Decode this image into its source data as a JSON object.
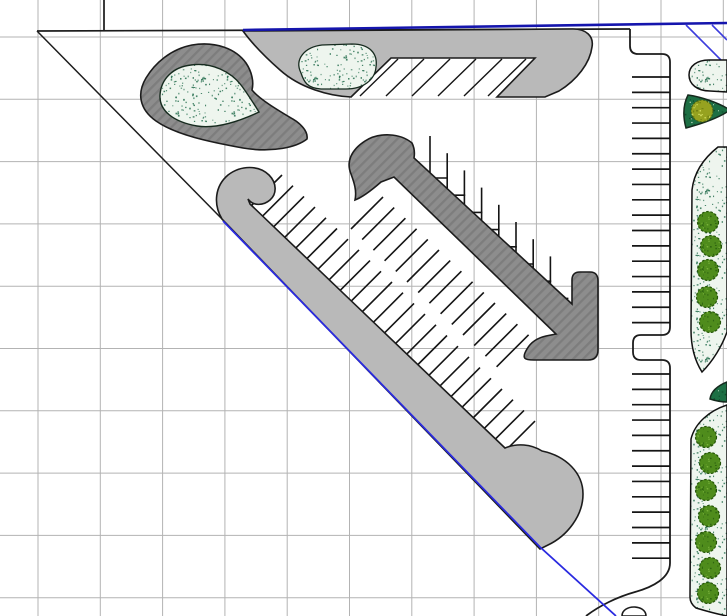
{
  "canvas": {
    "width": 727,
    "height": 616,
    "background": "#ffffff",
    "kind": "cad-site-plan-parking-layout"
  },
  "colors": {
    "grid": "#b3b3b3",
    "outline": "#1c1c1c",
    "curb_light": "#b9b9b9",
    "curb_dark_base": "#8d8d8d",
    "curb_dark_hatch": "#7d7d7d",
    "boundary_blue": "#1515ad",
    "guide_blue": "#3c3cdd",
    "diag_blue": "#2a2ae0",
    "bed_fill": "#eef5ee",
    "bed_speck": "#2c7253",
    "bed_outline": "#162a1e",
    "dense_fill": "#1d6f44",
    "dense_speck_dark": "#0d4527",
    "dense_speck_light": "#cfe3cf",
    "olive_base": "#96a220",
    "olive_dark": "#6a7a10",
    "olive_light": "#d2dd5e",
    "tree_base": "#4f8c1c",
    "tree_dark": "#2d6410",
    "tree_light": "#7ab33b",
    "tree_edge": "#245409",
    "tick": "#141414",
    "corner_tick": "#3a3a3a"
  },
  "grid": {
    "spacing": 62.3,
    "offset_x": 38,
    "offset_y": 37,
    "cols": 12,
    "rows": 10
  },
  "boundary_lines": [
    {
      "name": "property-top-line",
      "x1": 37,
      "y1": 31,
      "x2": 630,
      "y2": 29,
      "stroke": "#1c1c1c",
      "w": 1.7
    },
    {
      "name": "property-hypotenuse-line",
      "x1": 37,
      "y1": 31,
      "x2": 223,
      "y2": 220,
      "stroke": "#1c1c1c",
      "w": 1.5
    },
    {
      "name": "corner-stub-line",
      "x1": 104,
      "y1": 0,
      "x2": 104,
      "y2": 30,
      "stroke": "#3a3a3a",
      "w": 2
    }
  ],
  "blue_lines": [
    {
      "name": "row-blue-top-line",
      "pts": "243,30 727,23",
      "stroke": "#1515ad",
      "w": 2.6
    },
    {
      "name": "row-blue-diagonal-line",
      "pts": "223,221 540,547 616,616",
      "stroke": "#2a2ae0",
      "w": 1.8
    },
    {
      "name": "guide-blue-diagonal-1",
      "pts": "686,25 727,66",
      "stroke": "#3c3cdd",
      "w": 1.6
    },
    {
      "name": "guide-blue-diagonal-2",
      "pts": "712,25 727,40",
      "stroke": "#3c3cdd",
      "w": 1.6
    }
  ],
  "right_road": {
    "curb_path": "M630,29 L630,46 Q630,54 638,54 L662,54 Q670,54 670,62 L670,327 Q670,335 662,335 L641,335 Q633,335 633,343 L633,352 Q633,360 641,360 L662,360 Q670,360 670,368 L670,563 C670,578 653,587 635,592 C617,597 599,606 586,616",
    "bottom_bump_path": "M622,616 C622,604 646,604 646,616 Z",
    "stall_rows": [
      {
        "x1": 632,
        "x2": 670,
        "y_start": 77,
        "step": 15.35,
        "count": 17
      },
      {
        "x1": 632,
        "x2": 670,
        "y_start": 374,
        "step": 15.35,
        "count": 13
      }
    ]
  },
  "top_median": {
    "outline_path": "M243,31 L573,29 C586,29 594,36 592,47 C590,63 577,80 559,91 L545,97 L497,97 L535,58 L391,58 L351,97 C329,96 300,88 280,70 C263,55 251,42 243,31 Z",
    "hatch_lines": [
      {
        "x1": 360,
        "y1": 96,
        "x2": 398,
        "y2": 59
      },
      {
        "x1": 386,
        "y1": 96,
        "x2": 424,
        "y2": 59
      },
      {
        "x1": 412,
        "y1": 96,
        "x2": 450,
        "y2": 59
      },
      {
        "x1": 438,
        "y1": 96,
        "x2": 476,
        "y2": 59
      },
      {
        "x1": 464,
        "y1": 96,
        "x2": 502,
        "y2": 59
      },
      {
        "x1": 488,
        "y1": 96,
        "x2": 526,
        "y2": 59
      }
    ],
    "bed_path": "M301,73 C294,59 305,47 322,45 L352,44 C369,44 378,53 376,67 C375,80 363,89 346,89 L321,89 C307,88 304,82 301,73 Z"
  },
  "teardrop_island": {
    "outer_path": "M307,139 C297,147 273,153 243,148 C210,142 176,135 156,121 C139,109 137,93 146,78 C155,63 171,49 192,45 C216,41 236,49 246,63 C252,72 254,82 252,90 C260,100 281,112 296,121 C304,127 308,133 307,139 Z",
    "bed_path": "M259,112 C240,121 216,129 197,126 C174,122 159,111 160,95 C161,79 173,67 191,65 C212,62 231,72 241,85 C247,93 254,104 259,112 Z"
  },
  "long_median": {
    "outline_path": "M222,219 C213,204 215,186 228,175 C241,165 259,165 269,175 C277,183 277,194 270,200 C263,206 253,206 248,199 L250,204 L505,448 C517,443 531,444 542,451 C566,456 583,473 583,494 C583,516 567,536 548,545 L540,549 Z",
    "stall_ticks": {
      "x0": 252,
      "y0": 205,
      "dx": 11.0,
      "dy": 10.7,
      "count": 24,
      "tdx": 30,
      "tdy": -30
    }
  },
  "center_median": {
    "outline_path": "M412,143 C400,133 379,132 365,141 C351,150 346,162 351,174 C354,182 357,191 355,200 C363,197 373,189 381,182 L394,177 L556,334 L546,336 C537,338 531,342 527,349 C521,359 525,360 534,360 L588,360 Q598,360 598,350 L598,281 Q598,272 590,272 L580,272 Q572,272 572,280 L572,304 L414,158 C415,152 414,147 412,143 Z",
    "stair_stalls": {
      "x0": 430,
      "y_bottom0": 178,
      "step": 17.2,
      "count": 8,
      "tick_len": 42,
      "h_len": 18,
      "h_back": 10
    },
    "angled_ticks": {
      "x0": 383,
      "y0": 197,
      "dx": 11.2,
      "dy": 10.6,
      "count": 14,
      "tdx": -32,
      "tdy": 32
    }
  },
  "landscape_right": {
    "petals": [
      {
        "name": "landscape-bed-petal-top",
        "fill": "stipple",
        "path": "M727,60 L709,60 C697,60 689,66 689,75 C689,84 697,91 710,91 L727,92 Z"
      },
      {
        "name": "landscape-bed-cone",
        "fill": "dense",
        "path": "M688,95 C702,97 719,103 730,110 C719,118 701,124 686,128 C683,117 683,105 688,95 Z"
      },
      {
        "name": "landscape-bed-leaf-middle",
        "fill": "stipple",
        "path": "M718,147 C704,158 694,172 692,190 L691,330 C691,346 695,361 702,372 C713,361 722,346 727,332 L727,147 Z"
      },
      {
        "name": "landscape-bed-wedge-small",
        "fill": "dense",
        "path": "M727,382 C717,386 711,392 710,399 C716,401 722,402 727,402 Z"
      },
      {
        "name": "landscape-bed-crescent-bottom",
        "fill": "stipple",
        "path": "M727,405 C709,411 695,423 691,439 L690,597 C690,601 692,605 696,608 C706,611 717,614 727,616 L727,405 Z"
      }
    ],
    "trees": {
      "r": 10.5,
      "centers": [
        [
          708,
          222
        ],
        [
          711,
          246
        ],
        [
          708,
          270
        ],
        [
          707,
          297
        ],
        [
          710,
          322
        ],
        [
          706,
          437
        ],
        [
          710,
          463
        ],
        [
          706,
          490
        ],
        [
          709,
          516
        ],
        [
          706,
          542
        ],
        [
          710,
          568
        ],
        [
          708,
          593
        ]
      ]
    },
    "shrub_cluster": {
      "cx": 702,
      "cy": 111,
      "r": 11
    }
  }
}
